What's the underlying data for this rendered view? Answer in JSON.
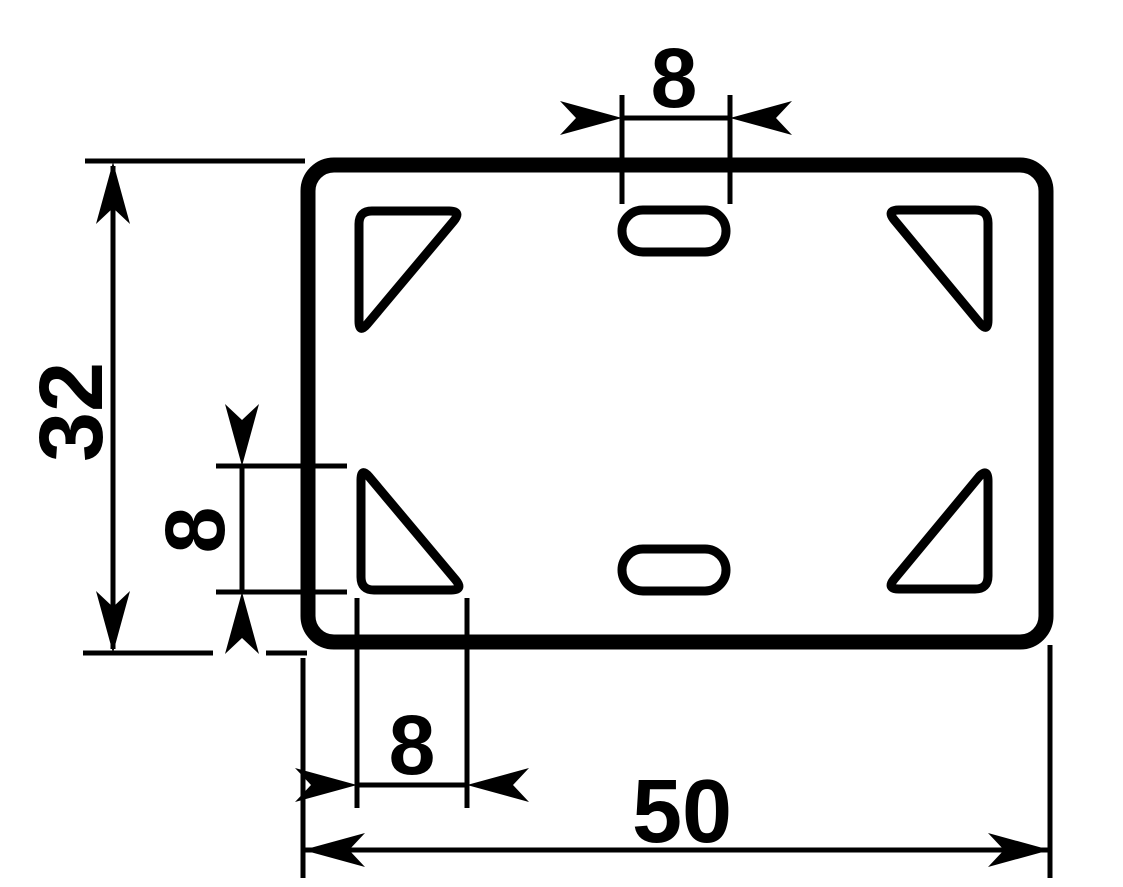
{
  "drawing": {
    "title": "dimensioned plate drawing",
    "colors": {
      "line": "#000000",
      "background": "#ffffff"
    },
    "dims": {
      "plate_height": {
        "label": "32",
        "value": 32
      },
      "plate_width": {
        "label": "50",
        "value": 50
      },
      "slot_width": {
        "label": "8",
        "value": 8
      },
      "cutout_height": {
        "label": "8",
        "value": 8
      },
      "cutout_width": {
        "label": "8",
        "value": 8
      }
    }
  }
}
